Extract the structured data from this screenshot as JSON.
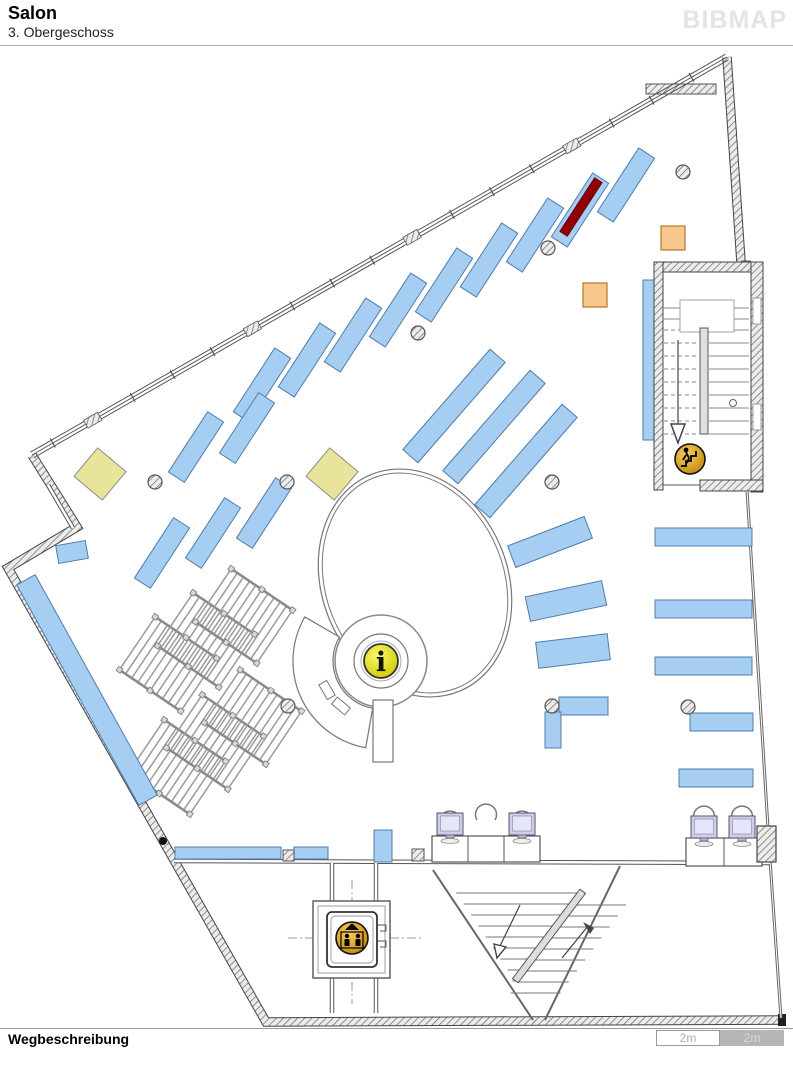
{
  "header": {
    "title": "Salon",
    "subtitle": "3. Obergeschoss",
    "logo": "BIBMAP"
  },
  "footer": {
    "label": "Wegbeschreibung",
    "scale": [
      {
        "label": "2m",
        "style": "light"
      },
      {
        "label": "2m",
        "style": "dark"
      }
    ]
  },
  "icons": {
    "info_glyph": "i",
    "info_icon": "information-point",
    "elevator_icon": "elevator",
    "stairs_icon": "stairs-down"
  },
  "colors": {
    "shelf_blue": "#a6cdf2",
    "shelf_border": "#4f7dab",
    "highlight_red": "#8e0006",
    "bin_orange": "#f8c78e",
    "bin_border": "#b5762e",
    "table_yellow": "#e9e49b",
    "table_border": "#8a8a8a",
    "info_yellow": "#f2ee2a",
    "icon_orange": "#eaa93c",
    "monitor_lavender": "#cdcdee",
    "wall": "#4a4a4a",
    "line": "#777777",
    "logo_gray": "#e4e4e4"
  },
  "plan": {
    "outline_hatched": "M32,455 L77,527 L8,568 L266,1022 L783,1020 M727,57 L741,262",
    "top_wall": [
      32,
      455,
      727,
      57
    ],
    "right_wall": "M741,262 L751,262 M747,490 L770,860 L781,1018",
    "apex_bar": [
      646,
      84,
      70,
      10
    ],
    "inner_walls": [
      [
        174,
        861,
        770,
        863
      ],
      [
        48,
        485,
        73,
        528
      ]
    ],
    "corridor_walls": [
      [
        332,
        863,
        332,
        1013
      ],
      [
        376,
        863,
        376,
        1013
      ]
    ],
    "stair_diag_walls": [
      [
        433,
        870,
        533,
        1020
      ],
      [
        620,
        866,
        545,
        1020
      ]
    ],
    "centerlines": [
      [
        288,
        938,
        424,
        938
      ],
      [
        352,
        880,
        352,
        1004
      ]
    ],
    "shelves_rot": [
      [
        262,
        385,
        76,
        19,
        -57
      ],
      [
        307,
        360,
        76,
        19,
        -57
      ],
      [
        353,
        335,
        76,
        19,
        -57
      ],
      [
        398,
        310,
        76,
        19,
        -57
      ],
      [
        444,
        285,
        76,
        19,
        -57
      ],
      [
        489,
        260,
        76,
        19,
        -57
      ],
      [
        535,
        235,
        76,
        19,
        -57
      ],
      [
        580,
        210,
        76,
        19,
        -57
      ],
      [
        626,
        185,
        76,
        19,
        -57
      ],
      [
        196,
        447,
        72,
        19,
        -57
      ],
      [
        247,
        428,
        72,
        19,
        -57
      ],
      [
        162,
        553,
        72,
        19,
        -57
      ],
      [
        213,
        533,
        72,
        19,
        -57
      ],
      [
        264,
        513,
        72,
        19,
        -57
      ],
      [
        454,
        406,
        133,
        20,
        -49
      ],
      [
        494,
        427,
        133,
        20,
        -49
      ],
      [
        526,
        461,
        133,
        20,
        -49
      ],
      [
        550,
        542,
        82,
        23,
        -21
      ],
      [
        566,
        601,
        78,
        25,
        -12
      ],
      [
        573,
        651,
        72,
        26,
        -7
      ],
      [
        87,
        690,
        252,
        21,
        61
      ],
      [
        72,
        552,
        30,
        18,
        -10
      ]
    ],
    "shelves_rect": [
      [
        655,
        528,
        97,
        18
      ],
      [
        655,
        600,
        97,
        18
      ],
      [
        655,
        657,
        97,
        18
      ],
      [
        690,
        713,
        63,
        18
      ],
      [
        679,
        769,
        74,
        18
      ],
      [
        559,
        697,
        49,
        18
      ],
      [
        545,
        712,
        16,
        36
      ],
      [
        175,
        847,
        106,
        12
      ],
      [
        294,
        847,
        34,
        12
      ],
      [
        374,
        830,
        18,
        32
      ],
      [
        643,
        280,
        12,
        160
      ]
    ],
    "highlight": [
      581,
      207,
      64,
      9,
      -57
    ],
    "bins": {
      "size": 24,
      "at": [
        [
          595,
          295
        ],
        [
          673,
          238
        ]
      ]
    },
    "yellow_tables": {
      "size": 37,
      "rot": 40,
      "at": [
        [
          100,
          474
        ],
        [
          332,
          474
        ]
      ]
    },
    "columns": {
      "r": 7,
      "at": [
        [
          418,
          333
        ],
        [
          548,
          248
        ],
        [
          683,
          172
        ],
        [
          155,
          482
        ],
        [
          287,
          482
        ],
        [
          552,
          482
        ],
        [
          688,
          707
        ],
        [
          552,
          706
        ],
        [
          288,
          706
        ]
      ]
    },
    "black_dots": [
      [
        163,
        841
      ],
      [
        766,
        839
      ]
    ],
    "racks": {
      "w": 64,
      "h": 74,
      "rot": -56,
      "rungs": 10,
      "at": [
        [
          168,
          664
        ],
        [
          206,
          640
        ],
        [
          244,
          616
        ],
        [
          177,
          767
        ],
        [
          215,
          742
        ],
        [
          253,
          717
        ]
      ]
    },
    "oval": {
      "cx": 415,
      "cy": 583,
      "rx": 93,
      "ry": 117,
      "rot": -22
    },
    "infodesk": {
      "cx": 381,
      "cy": 661,
      "r_outer": 46,
      "r_inner": 27,
      "icon_r": 17
    },
    "stairwell": {
      "x": 654,
      "y": 262,
      "w": 109,
      "h": 230,
      "icon": [
        690,
        459,
        15
      ]
    },
    "elevator": {
      "x": 313,
      "y": 901,
      "s": 77,
      "icon": [
        352,
        938,
        16
      ]
    },
    "diag_stairs": {
      "divider": [
        549,
        936,
        112,
        7,
        -53
      ]
    },
    "computers": {
      "bottom": {
        "desk": [
          432,
          836,
          108,
          26
        ],
        "dividers": [
          468,
          504
        ],
        "chairs": [
          [
            450,
            818
          ],
          [
            486,
            811
          ],
          [
            522,
            818
          ]
        ],
        "monitors": [
          [
            450,
            827
          ],
          [
            522,
            827
          ]
        ]
      },
      "right": {
        "desk": [
          686,
          838,
          76,
          28
        ],
        "dividers": [
          724
        ],
        "chairs": [
          [
            704,
            813
          ],
          [
            742,
            813
          ]
        ],
        "monitors": [
          [
            704,
            830
          ],
          [
            742,
            830
          ]
        ]
      }
    },
    "wall_column": [
      757,
      826,
      19,
      36
    ]
  }
}
